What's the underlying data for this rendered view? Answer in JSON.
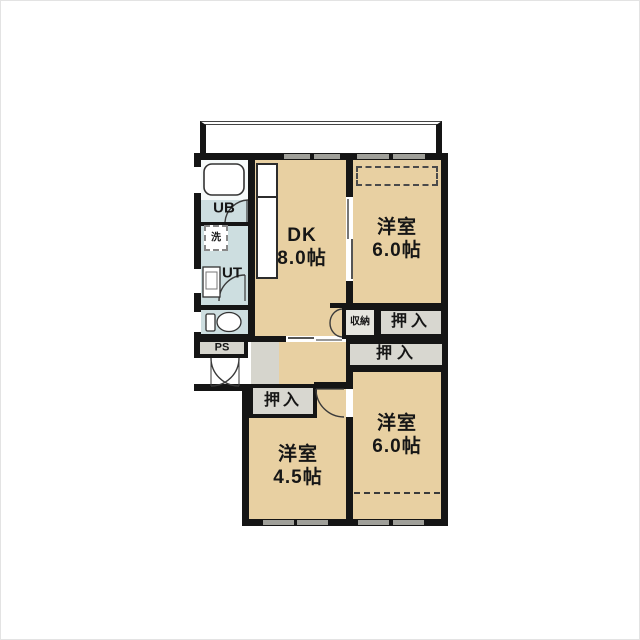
{
  "plan": {
    "type": "floorplan",
    "balcony_label": "",
    "labels": {
      "ub": "UB",
      "laundry": "洗",
      "ut": "UT",
      "ps": "PS",
      "storage": "収納",
      "closet_ne": "押入",
      "closet_mid": "押入",
      "closet_sw": "押入"
    },
    "rooms": {
      "dk": {
        "name": "DK",
        "area": "8.0帖"
      },
      "bedroom_ne": {
        "name": "洋室",
        "area": "6.0帖"
      },
      "bedroom_se": {
        "name": "洋室",
        "area": "6.0帖"
      },
      "bedroom_sw": {
        "name": "洋室",
        "area": "4.5帖"
      }
    },
    "colors": {
      "room_fill": "#e8d0a2",
      "wet_area_fill": "#cddee0",
      "closet_fill": "#d8d7d0",
      "storage_fill": "#e6e5de",
      "service_fill": "#d6d5cd",
      "wall": "#151515",
      "window_mark": "#a0a09a"
    }
  }
}
